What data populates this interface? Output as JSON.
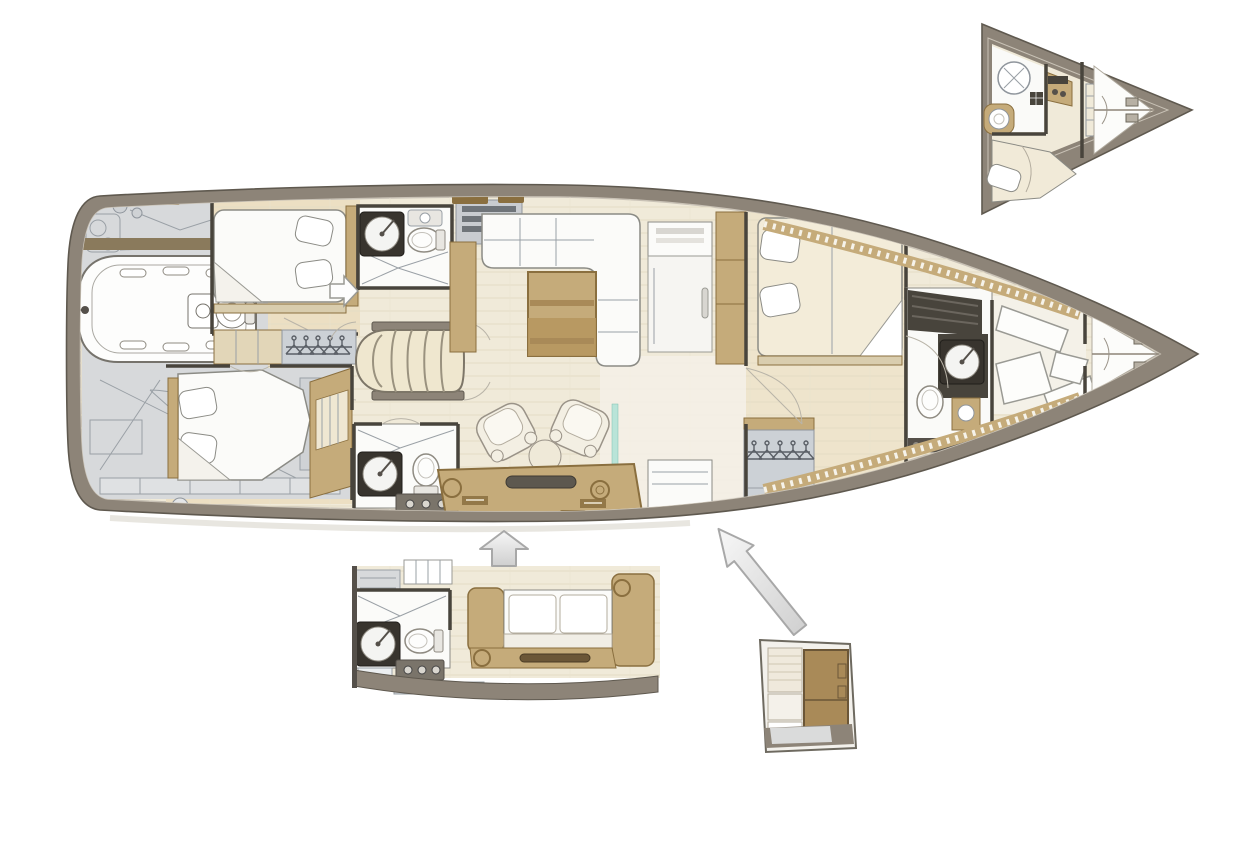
{
  "canvas": {
    "width": 1250,
    "height": 850,
    "background": "#ffffff"
  },
  "palette": {
    "paper": "#ffffff",
    "hullBand": "#8d8478",
    "hullBandLight": "#c9c2b6",
    "hullLine": "#5f594f",
    "deckGray": "#d7d9db",
    "deckGrayLight": "#e6e8ea",
    "deckLine": "#9aa0a6",
    "floor": "#f0ead9",
    "floorStreak": "#e4dcc5",
    "floorCabin": "#ecdfc3",
    "wood": "#c5ab7a",
    "woodDark": "#b6975f",
    "woodDeep": "#8a6f3f",
    "darkWall": "#48443c",
    "furnWhite": "#fbfbf9",
    "furnOutline": "#8b8b85",
    "grayFurn": "#ccd1d6",
    "grayFurnLine": "#8f959c",
    "teal": "#b9e4d8",
    "arrowFillLight": "#f7f7f7",
    "arrowFillDark": "#cfcfcf",
    "arrowStroke": "#a8a8a8",
    "shadow": "#dcd8cf"
  },
  "figure": {
    "type": "yacht-interior-floor-plan",
    "views": [
      {
        "id": "main-plan"
      },
      {
        "id": "bow-cabin-inset"
      },
      {
        "id": "aft-galley-inset"
      },
      {
        "id": "stowage-inset"
      }
    ],
    "arrows": [
      {
        "id": "up-arrow",
        "direction": "up"
      },
      {
        "id": "diagonal-arrow",
        "direction": "up-left"
      }
    ]
  }
}
